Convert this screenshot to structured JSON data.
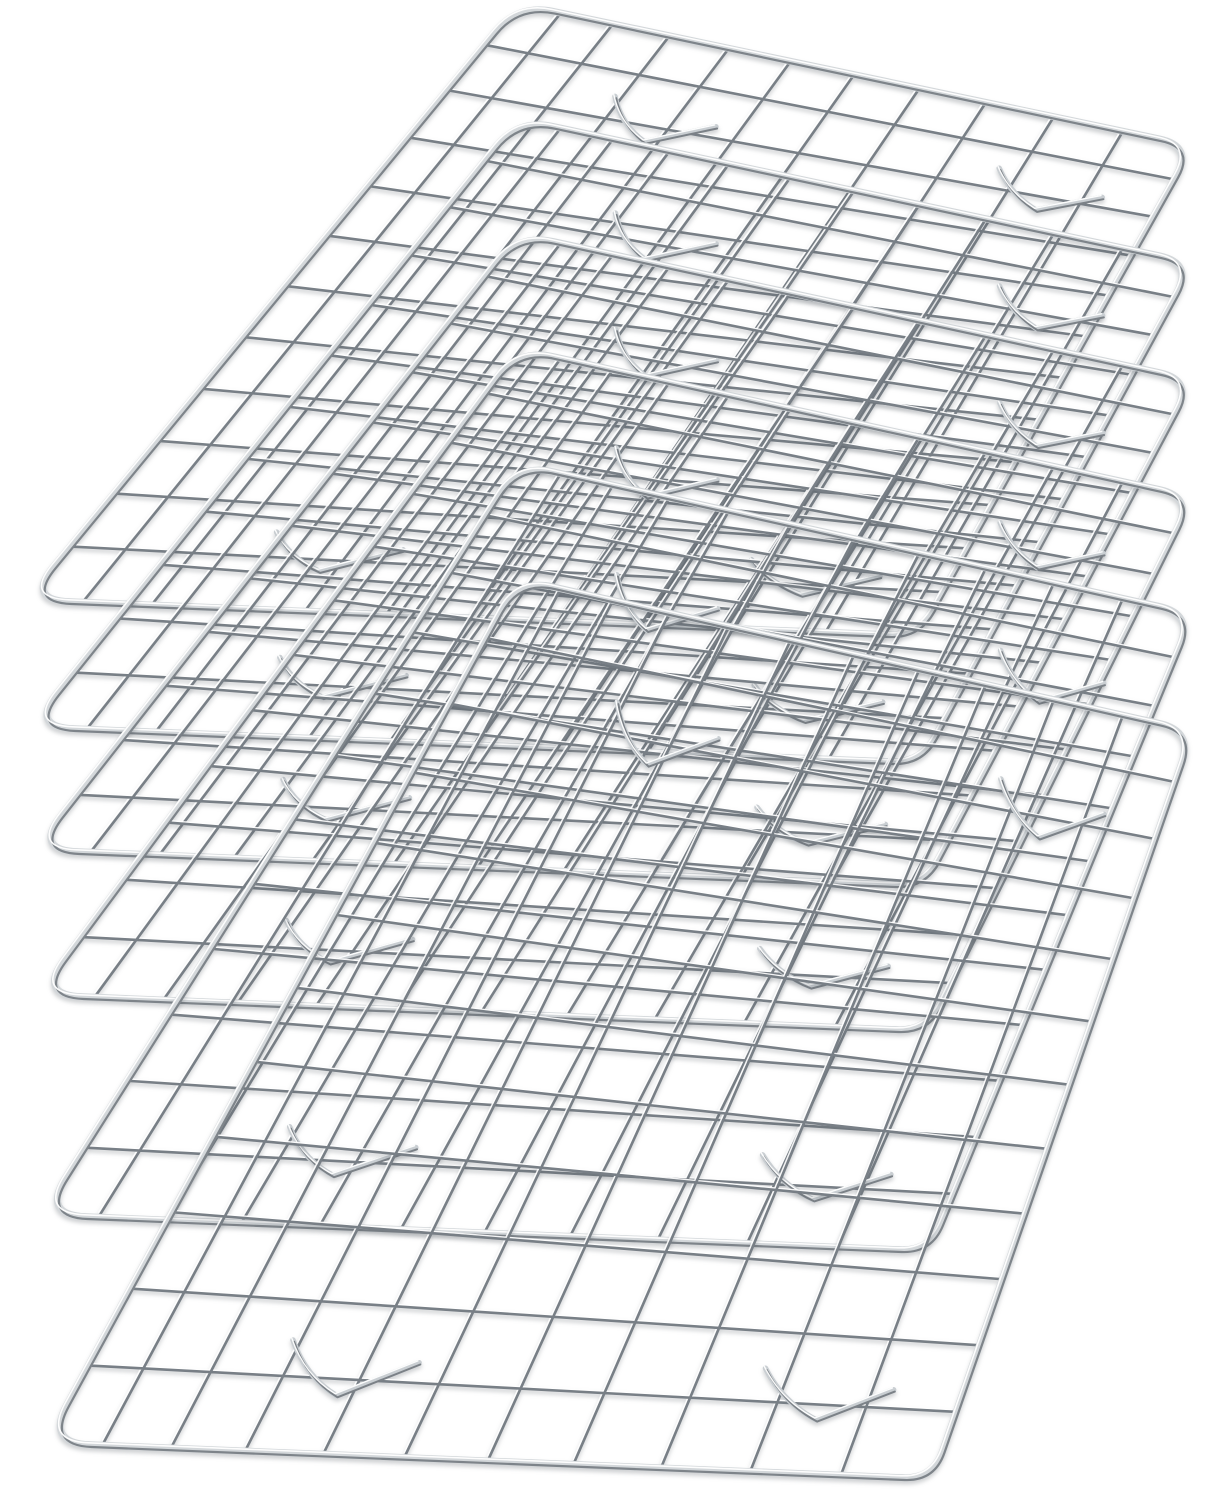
{
  "image": {
    "kind": "product-photo",
    "background_color": "#ffffff"
  },
  "product": {
    "type": "wire-cooling-rack",
    "quantity": 6,
    "finish": "stainless-steel",
    "features": [
      "rectangular wire grid",
      "rounded corner frame",
      "left-end U tips",
      "V-shaped raised feet"
    ]
  },
  "palette": {
    "background": "#ffffff",
    "wire_dark": "#787f86",
    "wire_glint": "#ffffff",
    "border_light": "#d3d7da",
    "border_dark": "#6f757b",
    "foot_light": "#c9ced2",
    "foot_dark": "#7b8187",
    "shadow": "rgba(80,86,92,0.28)"
  },
  "geometry": {
    "canvas": {
      "width": 1210,
      "height": 1500
    },
    "grid": {
      "columns": 10,
      "rows": 11,
      "col_power": 1.15,
      "row_power": 1.08
    },
    "corner_radii": [
      36,
      34,
      30,
      44
    ],
    "feet": [
      [
        0.3,
        0.12
      ],
      [
        0.85,
        0.12
      ],
      [
        0.3,
        0.88
      ],
      [
        0.85,
        0.88
      ]
    ],
    "racks": [
      {
        "id": "cooling-rack-1",
        "corners": {
          "back_left": [
            518,
            4
          ],
          "back_right": [
            1193,
            146
          ],
          "front_right": [
            918,
            636
          ],
          "front_left": [
            26,
            600
          ]
        }
      },
      {
        "id": "cooling-rack-2",
        "corners": {
          "back_left": [
            518,
            119
          ],
          "back_right": [
            1193,
            263
          ],
          "front_right": [
            921,
            763
          ],
          "front_left": [
            30,
            727
          ]
        }
      },
      {
        "id": "cooling-rack-3",
        "corners": {
          "back_left": [
            518,
            234
          ],
          "back_right": [
            1193,
            380
          ],
          "front_right": [
            924,
            886
          ],
          "front_left": [
            34,
            850
          ]
        }
      },
      {
        "id": "cooling-rack-4",
        "corners": {
          "back_left": [
            518,
            349
          ],
          "back_right": [
            1193,
            497
          ],
          "front_right": [
            927,
            1031
          ],
          "front_left": [
            38,
            995
          ]
        }
      },
      {
        "id": "cooling-rack-5",
        "corners": {
          "back_left": [
            518,
            464
          ],
          "back_right": [
            1193,
            614
          ],
          "front_right": [
            930,
            1251
          ],
          "front_left": [
            42,
            1215
          ]
        }
      },
      {
        "id": "cooling-rack-6",
        "corners": {
          "back_left": [
            518,
            579
          ],
          "back_right": [
            1193,
            731
          ],
          "front_right": [
            933,
            1479
          ],
          "front_left": [
            46,
            1443
          ]
        }
      }
    ]
  }
}
